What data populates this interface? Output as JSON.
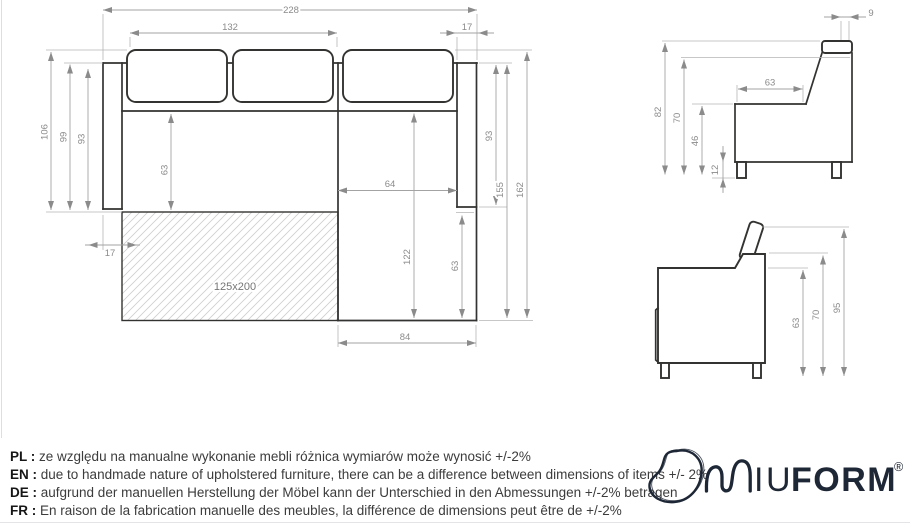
{
  "colors": {
    "outline": "#333331",
    "dimension_line": "#a3a3a3",
    "dimension_text": "#8b8b8b",
    "brand_navy": "#1e2736",
    "hatch": "#cfcfcf"
  },
  "top_view": {
    "bed_label": "125x200",
    "dims": {
      "total_width": "228",
      "seat_width": "132",
      "armrest_top": "17",
      "depth_total": "106",
      "depth_back": "99",
      "depth_inner": "93",
      "seat_depth": "63",
      "chaise_inner": "64",
      "chaise_length": "122",
      "chaise_depth": "63",
      "right_depth": "93",
      "right_length_inner": "155",
      "right_length": "162",
      "bed_offset": "17",
      "chaise_width": "84"
    }
  },
  "side_view_back": {
    "dims": {
      "headrest_depth": "9",
      "height_total": "82",
      "height_back": "70",
      "seat_depth": "63",
      "seat_height": "46",
      "leg_height": "12"
    }
  },
  "side_view_seat": {
    "dims": {
      "seat_height": "63",
      "back_height": "70",
      "height_total": "95"
    }
  },
  "disclaimer": {
    "rows": [
      {
        "label": "PL :",
        "text": "ze względu na manualne wykonanie mebli różnica wymiarów może wynosić +/-2%"
      },
      {
        "label": "EN :",
        "text": "due to handmade nature of upholstered furniture, there can be a difference between dimensions of items +/- 2%"
      },
      {
        "label": "DE :",
        "text": "aufgrund der manuellen Herstellung der Möbel kann der Unterschied in den Abmessungen +/-2% betragen"
      },
      {
        "label": "FR :",
        "text": "En raison de la fabrication manuelle des meubles, la différence de dimensions peut être de +/-2%"
      }
    ]
  },
  "logo": {
    "iu": "IU",
    "form": "FORM",
    "registered": "®"
  }
}
